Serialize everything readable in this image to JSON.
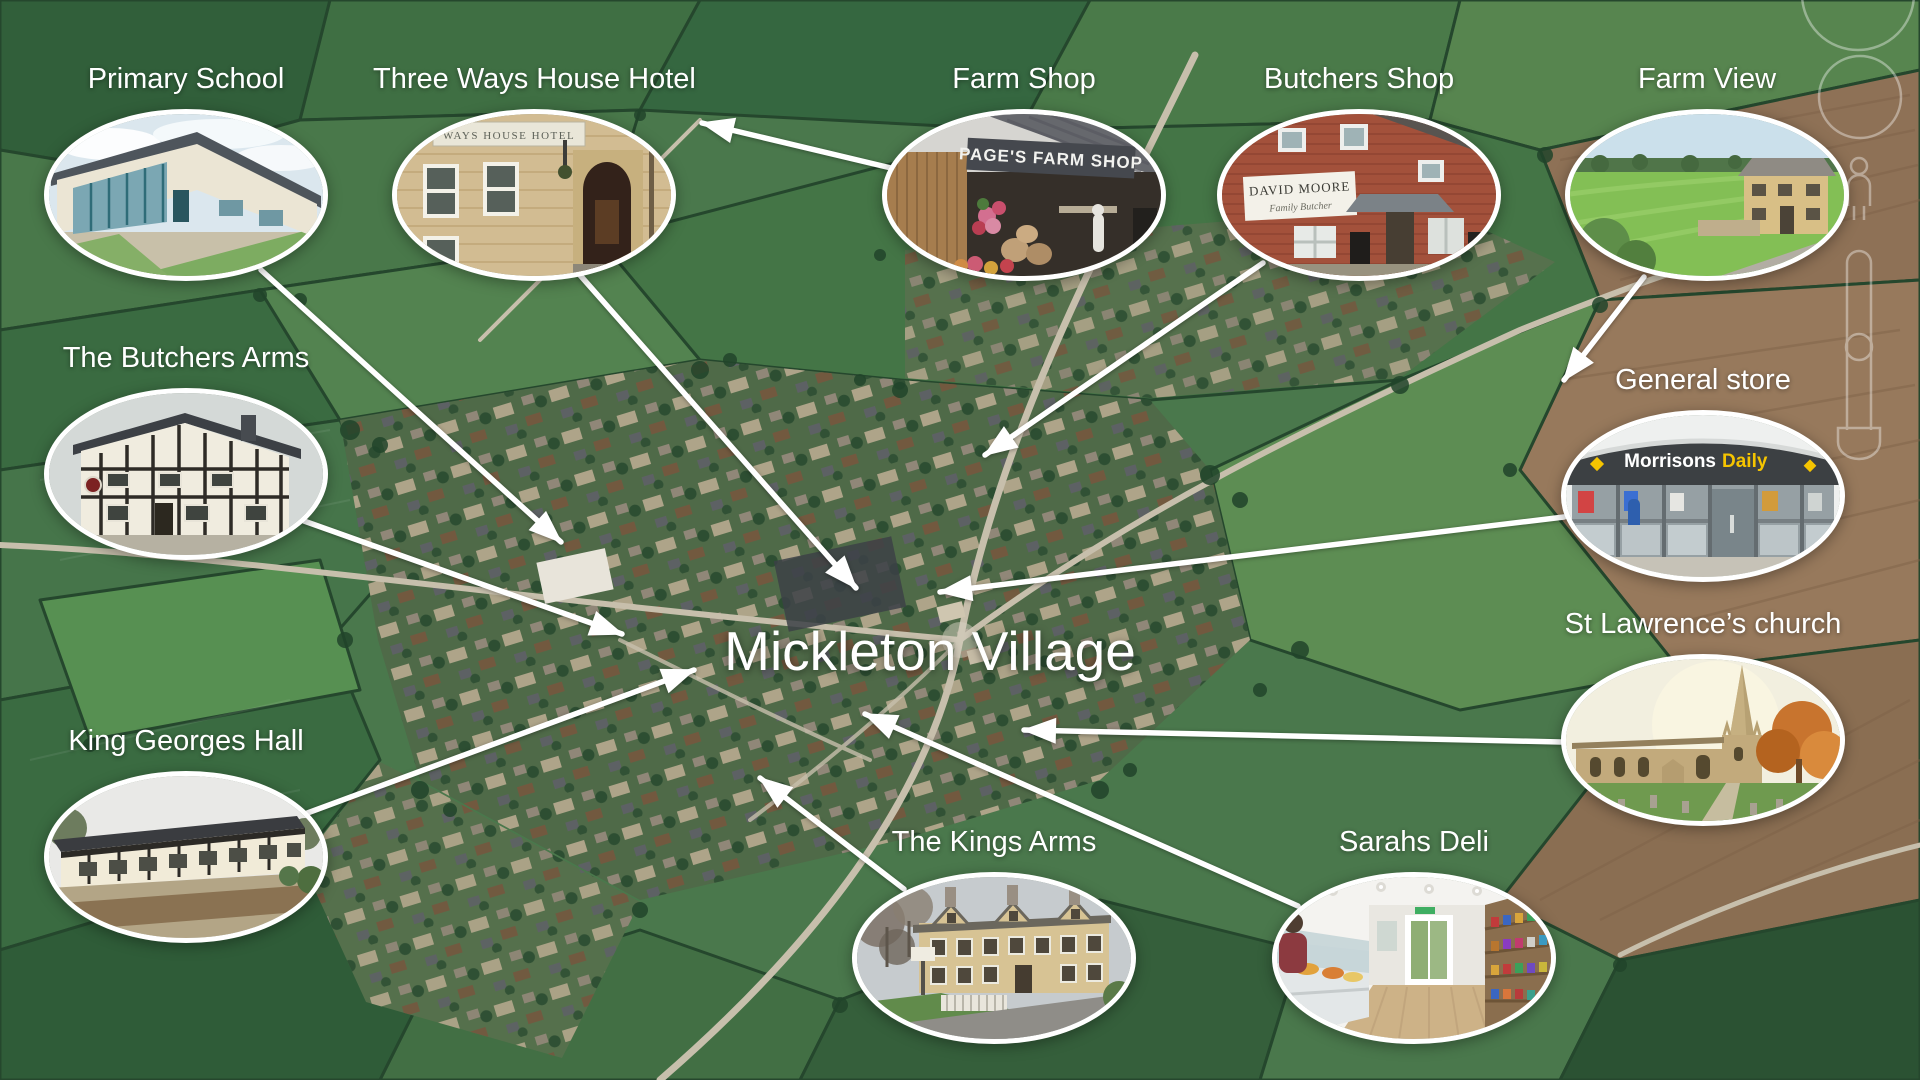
{
  "title": "Mickleton Village",
  "colors": {
    "annotation_white": "#ffffff",
    "morrisons_daily_yellow": "#f5c400"
  },
  "locations": [
    {
      "id": "primary-school",
      "label": "Primary School"
    },
    {
      "id": "three-ways-house-hotel",
      "label": "Three Ways House Hotel",
      "sign_text": "WAYS HOUSE HOTEL"
    },
    {
      "id": "farm-shop",
      "label": "Farm Shop",
      "sign_text": "PAGE'S FARM SHOP"
    },
    {
      "id": "butchers-shop",
      "label": "Butchers Shop",
      "sign_text": "DAVID MOORE",
      "sign_subtext": "Family Butcher"
    },
    {
      "id": "farm-view",
      "label": "Farm View"
    },
    {
      "id": "the-butchers-arms",
      "label": "The Butchers Arms"
    },
    {
      "id": "general-store",
      "label": "General store",
      "sign_text": "Morrisons",
      "sign_accent": "Daily"
    },
    {
      "id": "st-lawrences-church",
      "label": "St Lawrence’s church"
    },
    {
      "id": "king-georges-hall",
      "label": "King Georges Hall"
    },
    {
      "id": "the-kings-arms",
      "label": "The Kings Arms"
    },
    {
      "id": "sarahs-deli",
      "label": "Sarahs Deli"
    }
  ]
}
